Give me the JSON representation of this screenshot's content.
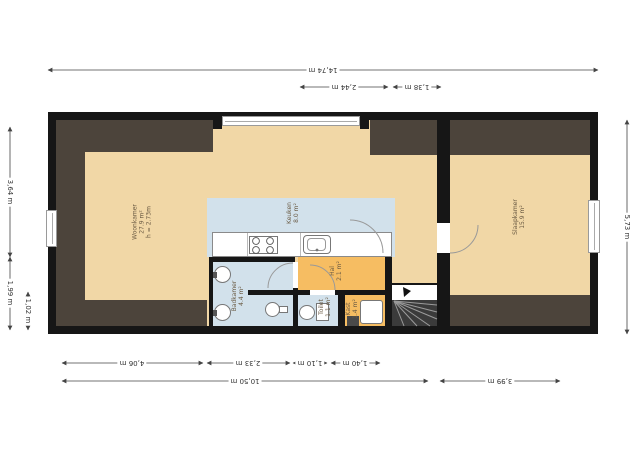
{
  "rooms": {
    "woonkamer": {
      "name": "Woonkamer",
      "area": "27.9 m²",
      "ceiling": "h = 2.73m"
    },
    "keuken": {
      "name": "Keuken",
      "area": "8.0 m²"
    },
    "slaapkamer": {
      "name": "Slaapkamer",
      "area": "15.9 m²"
    },
    "badkamer": {
      "name": "Badkamer",
      "area": "4.4 m²"
    },
    "toilet": {
      "name": "Toilet",
      "area": "1.1 m²"
    },
    "hal": {
      "name": "Hal",
      "area": "2.1 m²"
    },
    "kast": {
      "name": "Kast",
      "area": "1.4 m²"
    }
  },
  "dimensions": {
    "top_total": "14,74 m",
    "top_seg1": "2,44 m",
    "top_seg2": "1,38 m",
    "bottom_seg1": "4,06 m",
    "bottom_seg2": "2,33 m",
    "bottom_seg3": "1,10 m",
    "bottom_seg4": "1,40 m",
    "bottom_total_left": "10,50 m",
    "bottom_total_right": "3,99 m",
    "left_seg1": "3,64 m",
    "left_seg2": "1,99 m",
    "left_seg3": "1,02 m",
    "right_total": "5,73 m"
  },
  "icons": [
    "stove-icon",
    "kitchen-sink-icon",
    "washbasin-icon",
    "pedestal-sink-icon",
    "toilet-icon",
    "washer-icon",
    "stairs-arrow-icon"
  ],
  "colors": {
    "wall": "#161616",
    "floor": "#f1d7a6",
    "wet_floor": "#d2e1eb",
    "hall_floor": "#f6bd62",
    "low_ceiling_zone": "#4c443b",
    "stairs": "#3b3b3b"
  }
}
